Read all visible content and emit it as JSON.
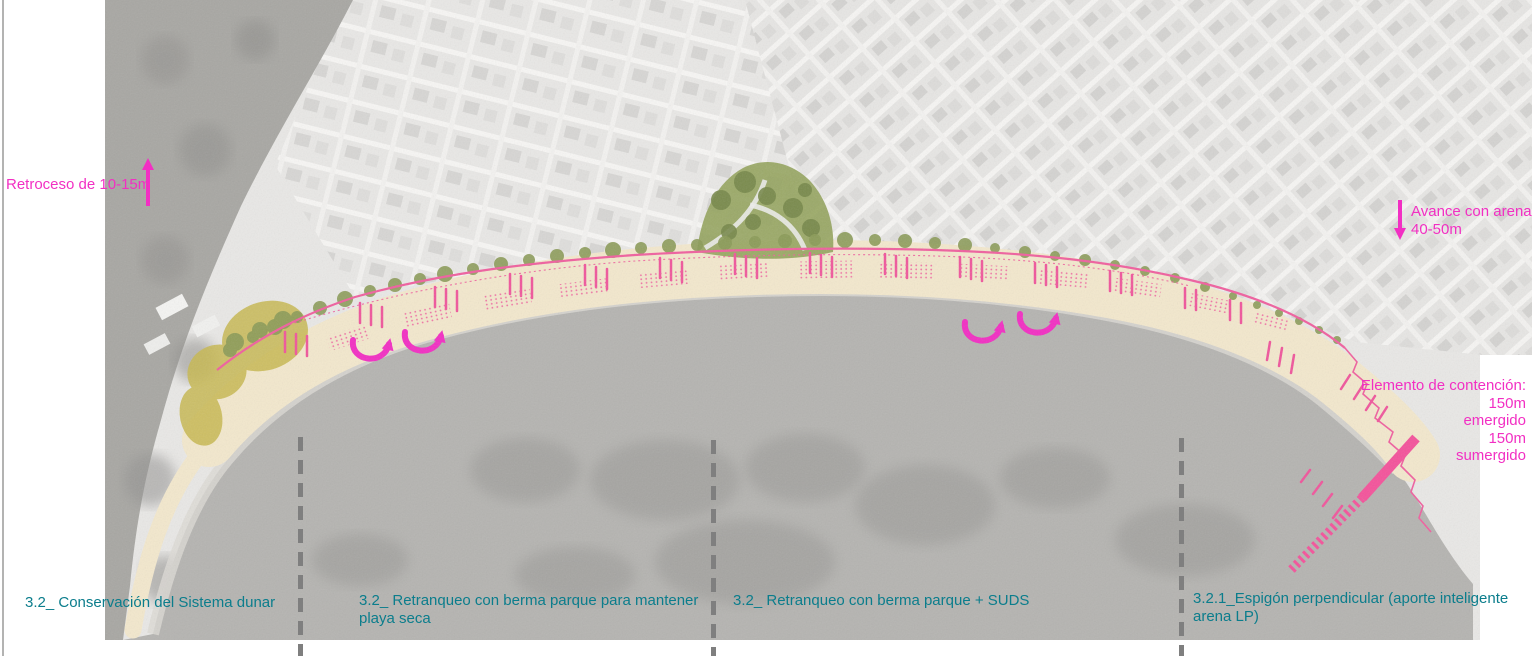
{
  "annotations": {
    "retroceso": {
      "text": "Retroceso de 10-15m"
    },
    "avance": {
      "line1": "Avance con arena",
      "line2": "40-50m"
    },
    "contencion": {
      "line1": "Elemento de contención:",
      "line2": "150m",
      "line3": "emergido",
      "line4": "150m",
      "line5": "sumergido"
    }
  },
  "sections": [
    {
      "line1": "3.2_ Conservación del Sistema dunar",
      "line2": ""
    },
    {
      "line1": "3.2_ Retranqueo  con berma parque para mantener",
      "line2": "playa seca"
    },
    {
      "line1": "3.2_ Retranqueo con berma  parque + SUDS",
      "line2": ""
    },
    {
      "line1": "3.2.1_Espigón perpendicular (aporte inteligente",
      "line2": "arena LP)"
    }
  ],
  "colors": {
    "magenta": "#f22fc3",
    "pink_line": "#f0609f",
    "groyne_pink": "#f4539b",
    "teal_text": "#0b7d8c",
    "divider_gray": "#7f7f7f",
    "sand": "#f3e8cd",
    "water": "#b5b4b1",
    "dune": "#c8b951",
    "tree_green": "#8b9b58"
  }
}
